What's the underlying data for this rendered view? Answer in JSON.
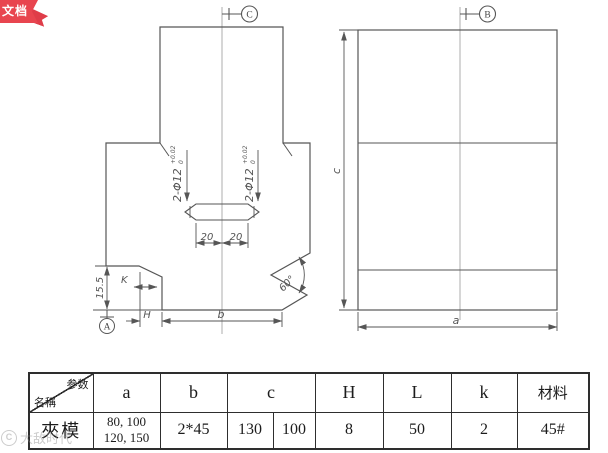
{
  "badge": {
    "text": "文档",
    "color": "#e8454f"
  },
  "watermark": {
    "logo": "C",
    "text": "大敌时代"
  },
  "drawing": {
    "front": {
      "datum_top": "C",
      "datum_bottom": "A",
      "hole_note_left": "2-Φ12",
      "hole_note_right": "2-Φ12",
      "tol_upper": "+0.02",
      "tol_lower": "0",
      "dim_20_left": "20",
      "dim_20_right": "20",
      "dim_step": "15.5",
      "label_k": "K",
      "label_h": "H",
      "label_b": "b",
      "angle": "60°"
    },
    "side": {
      "datum_top": "B",
      "label_c": "c",
      "label_a": "a"
    }
  },
  "table": {
    "corner": {
      "param": "参数",
      "name": "名稱"
    },
    "headers": [
      "a",
      "b",
      "c",
      "H",
      "L",
      "k",
      "材料"
    ],
    "row": {
      "name": "夾模",
      "a1": "80, 100",
      "a2": "120, 150",
      "b": "2*45",
      "c1": "130",
      "c2": "100",
      "h": "8",
      "l": "50",
      "k": "2",
      "material": "45#"
    }
  }
}
